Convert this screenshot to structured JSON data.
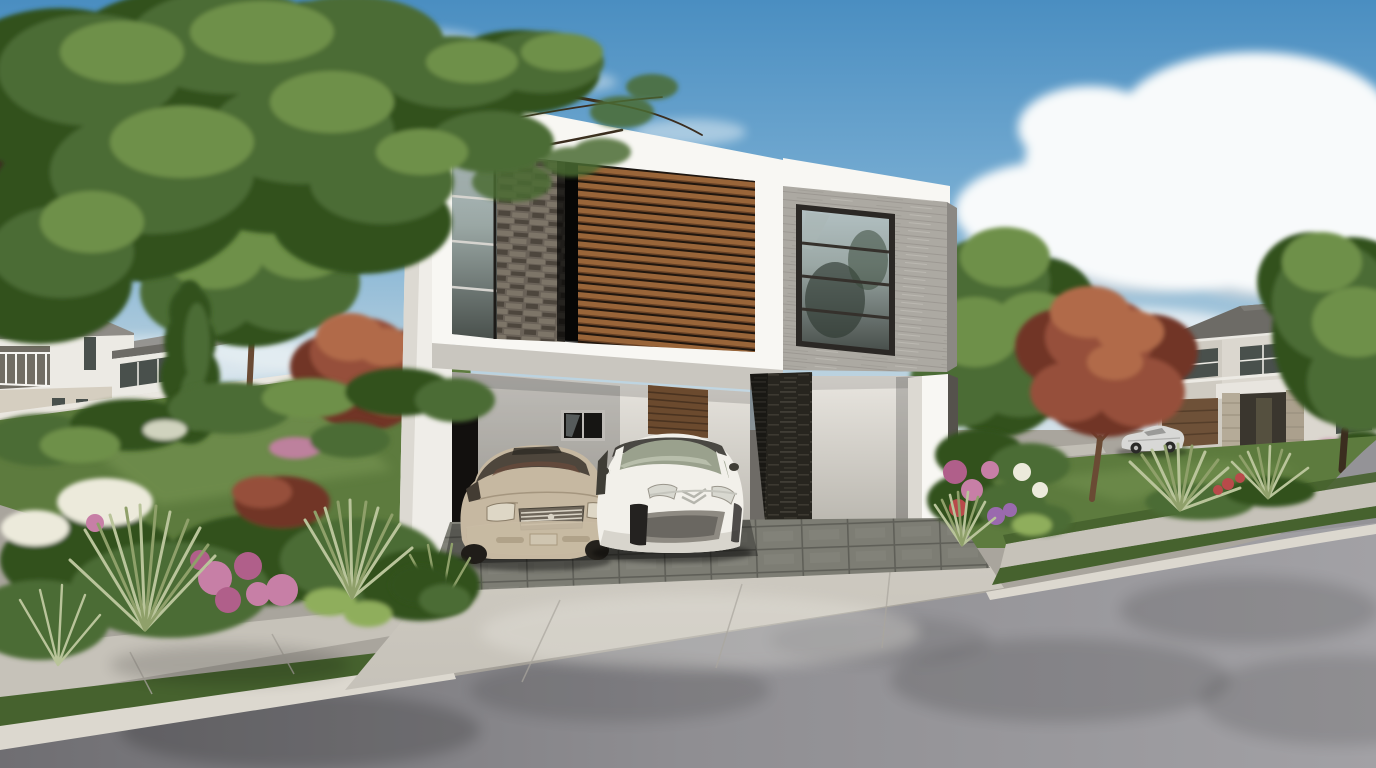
{
  "meta": {
    "type": "architectural-exterior-rendering",
    "description": "Photorealistic 3D rendering of a modern two-story white house on a suburban street corner: open carport with a beige sedan and a white minivan, horizontal wood-slat facade, dark stacked-slate column, gray concrete volume with corner picture window, lush flower gardens, neighboring two-story houses, curved corner sidewalk and asphalt street under a blue sky with large cumulus clouds"
  },
  "scene": {
    "setting": "suburban street corner, daytime, partly cloudy sky",
    "main_house": {
      "style": "modern two-story flat-roof volume",
      "materials": [
        "white stucco",
        "horizontal wood slats",
        "dark stacked slate",
        "gray board-formed concrete"
      ],
      "features": [
        "open double carport",
        "slate-clad pier",
        "upper-floor wood louver band",
        "large 4-pane picture window in concrete volume",
        "ribbon window over stone pier",
        "wood louver entry door",
        "small carport window",
        "tiled carport floor"
      ]
    },
    "vehicles": [
      {
        "label": "beige luxury sedan",
        "location": "carport left bay"
      },
      {
        "label": "white compact minivan",
        "location": "carport right bay"
      },
      {
        "label": "silver convertible",
        "location": "street beside neighboring house"
      }
    ],
    "neighborhood": {
      "left_background": "two white two-story houses with gray hip roofs, balcony and white garden wall",
      "right_background": "large gray two-story house with dark hip roof, stone entry pillars and brown garage door"
    },
    "landscape": [
      "mature tree overhanging top-left corner",
      "red-leaf ornamental trees",
      "dark italian cypress",
      "pink hydrangea and white flower beds",
      "pale ornamental grass fans",
      "manicured lawns"
    ],
    "hardscape": [
      "slate tile carport floor",
      "concrete driveway apron",
      "sidewalk with grass verge and curb",
      "curved corner sidewalk",
      "asphalt street",
      "distant cross street"
    ]
  },
  "palette": {
    "sky_top": "#4a8ec1",
    "sky_mid": "#79aed3",
    "sky_low": "#b7d0de",
    "sky_horizon": "#e4ebee",
    "cloud": "#f8fafb",
    "cloud_shadow": "#ccd5db",
    "white_bright": "#f8f7f3",
    "white": "#efede8",
    "white_shadow": "#dcd9d2",
    "soffit": "#c9c6bf",
    "wood": "#996539",
    "wood_dark": "#6e4426",
    "wood_gap": "#20160e",
    "stone": "#6a6258",
    "stone_light": "#7d7568",
    "stone_dark": "#4d463d",
    "slate": "#27251f",
    "slate_light": "#413e36",
    "concrete": "#aca9a2",
    "concrete_shade": "#8e8b85",
    "glass": "#49504c",
    "glass_light": "#9aa7a4",
    "glass_sky": "#b2c0c2",
    "frame": "#2b2825",
    "wall_int": "#e9e6e0",
    "wall_int_dark": "#b3b0a8",
    "opening_dark": "#161412",
    "door_wood": "#6b4a2e",
    "tile": "#7d7d74",
    "tile_dark": "#5f5f58",
    "drive": "#cdc9c0",
    "sidewalk": "#c6c2b9",
    "curb": "#dcd8cf",
    "asphalt": "#8f8e92",
    "asphalt_dark": "#6f6e72",
    "asphalt_light": "#a2a1a5",
    "grass": "#5d7b3e",
    "grass_dark": "#46622e",
    "grass_light": "#7a9855",
    "leaf": "#4c6c34",
    "leaf_dark": "#32511f",
    "leaf_light": "#6e9048",
    "leaf_pale": "#8fae5c",
    "red_leaf": "#96503a",
    "red_leaf_dark": "#713628",
    "red_leaf_light": "#b16a4a",
    "trunk": "#3b2d1f",
    "trunk_light": "#6a4a34",
    "bg_wall": "#eceae4",
    "bg_beige": "#d5cec0",
    "bg_roof": "#8f8c87",
    "bg_roof_dark": "#6d6b66",
    "bg_wall2": "#dbd7cf",
    "pink": "#c77fa6",
    "pink_deep": "#b05f8a",
    "white_flower": "#eceadb",
    "purple": "#9a6aae",
    "red_flower": "#b84a4a",
    "yucca": "#b9c49a",
    "yucca_dark": "#8fa06a",
    "car_beige": "#c6b8a1",
    "car_beige_dark": "#a8997f",
    "car_white": "#f2f0ea",
    "car_white_shadow": "#d8d5cd",
    "car_glass": "#4e463c",
    "car_silver": "#d8d8d6",
    "chrome": "#d9d3c5",
    "grille": "#6e665a",
    "bumper_mesh": "#8e8a82",
    "van_glass": "#9aa18d",
    "van_roof": "#3c3a34"
  }
}
